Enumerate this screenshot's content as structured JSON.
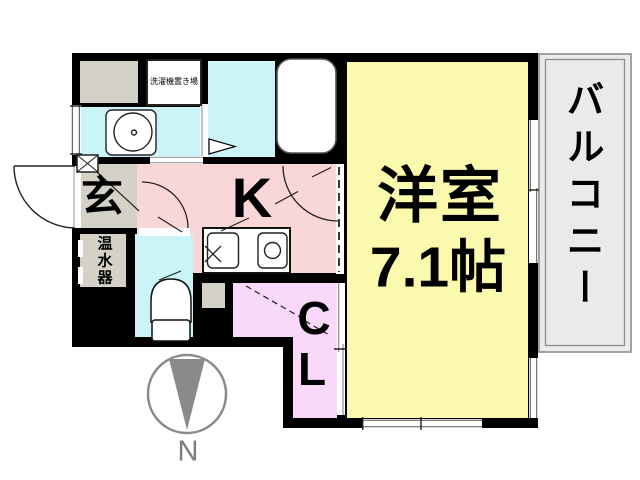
{
  "plan_type": "apartment-floor-plan",
  "rooms": {
    "western": {
      "label": "洋室",
      "size": "7.1帖",
      "color": "#FBF9AD"
    },
    "kitchen": {
      "label": "K",
      "color": "#F9D7D9"
    },
    "entrance": {
      "label": "玄",
      "color": "#D4D1C6"
    },
    "closet": {
      "line1": "C",
      "line2": "L",
      "color": "#F9D8F9"
    },
    "balcony": {
      "label": "バルコニー",
      "color": "#EAEAEA",
      "border_color": "#8F8F8F"
    },
    "laundry": {
      "label": "洗濯機置き場"
    },
    "water_heater": {
      "label": "温水器",
      "color": "#D4D1C6"
    },
    "bathroom": {
      "color": "#CBF4F9"
    },
    "toilet": {
      "color": "#CBF4F9"
    },
    "washstand": {
      "color": "#CBF4F9"
    },
    "storage": {
      "color": "#D4D1C6"
    }
  },
  "compass": {
    "label": "N",
    "color": "#8A8A8A"
  },
  "walls": {
    "color": "#000000"
  },
  "background": "#FFFFFF"
}
